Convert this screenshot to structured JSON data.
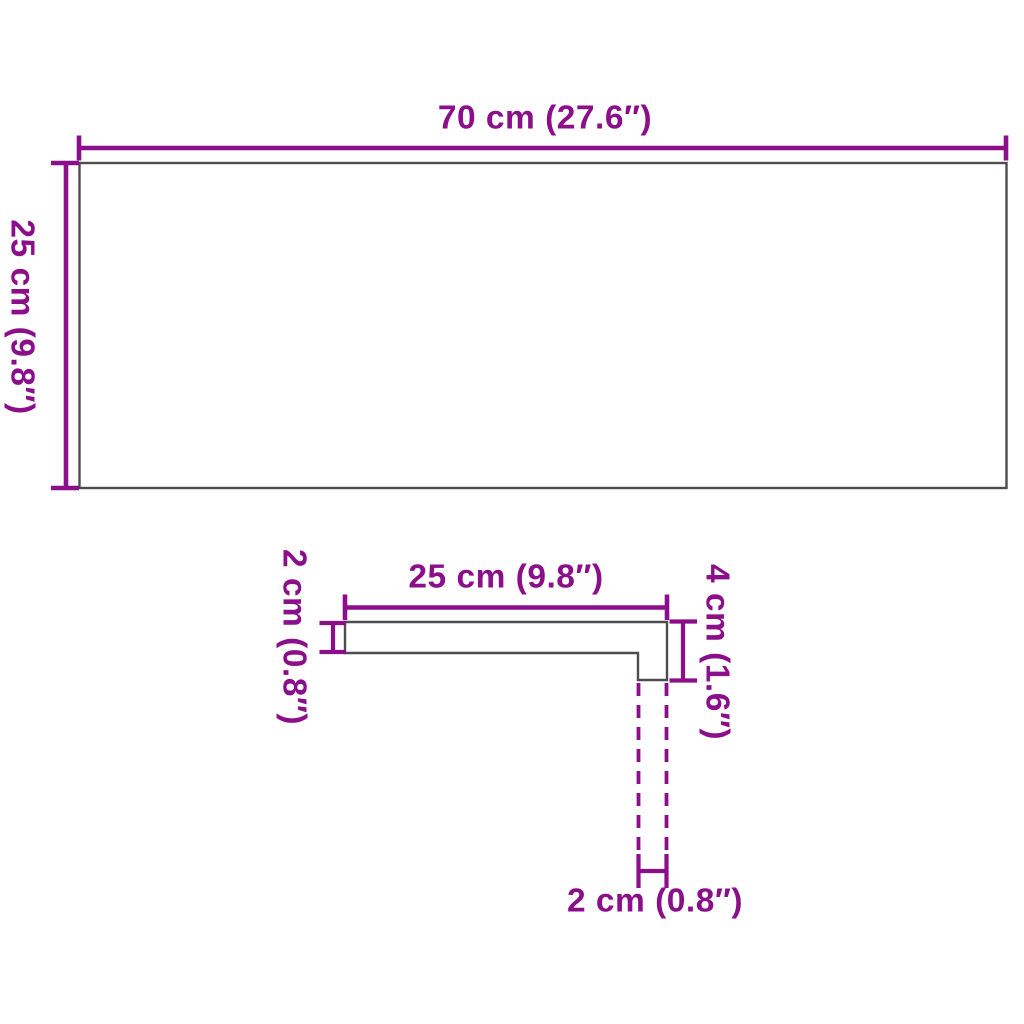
{
  "colors": {
    "dimension_magenta": "#8B0E8B",
    "outline_gray": "#4D4D4D",
    "background": "#FFFFFF"
  },
  "top_view": {
    "width_label": "70 cm (27.6″)",
    "height_label": "25 cm (9.8″)"
  },
  "profile_view": {
    "width_label": "25 cm (9.8″)",
    "thickness_label": "2 cm (0.8″)",
    "nose_height_label": "4 cm (1.6″)",
    "nose_overhang_label": "2 cm (0.8″)"
  }
}
